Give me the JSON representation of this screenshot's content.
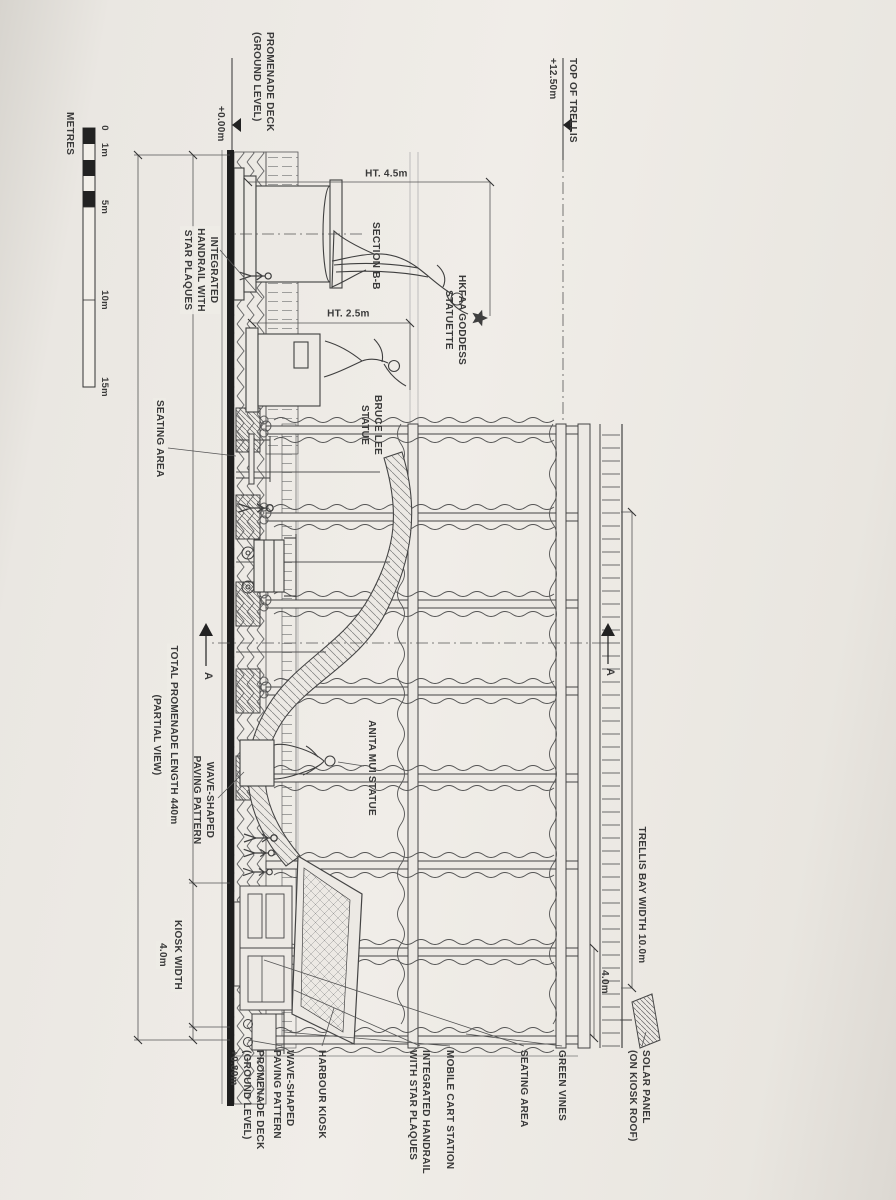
{
  "colors": {
    "paper": "#ECE9E4",
    "ink": "#3A3A3A",
    "line": "#444444"
  },
  "scale_bar": {
    "title": "METRES",
    "ticks": [
      "0",
      "1m",
      "5m",
      "10m",
      "15m"
    ]
  },
  "levels": {
    "promenade_deck": {
      "name": "PROMENADE DECK\n(GROUND LEVEL)",
      "value": "+0.00m"
    },
    "top_of_trellis": {
      "name": "TOP OF TRELLIS",
      "value": "+12.50m"
    }
  },
  "dimensions": {
    "goddess_height": "HT. 4.5m",
    "bruce_lee_height": "HT. 2.5m",
    "total_length": "TOTAL PROMENADE LENGTH 440m",
    "total_length_note": "(PARTIAL VIEW)",
    "kiosk_width_label": "KIOSK WIDTH",
    "kiosk_width_value": "4.0m",
    "trellis_bay_width": "TRELLIS BAY WIDTH 10.0m",
    "end_bay_width": "4.0m"
  },
  "section_markers": {
    "a": "A",
    "b": "SECTION B-B"
  },
  "labels": {
    "handrail_left": "INTEGRATED\nHANDRAIL WITH\nSTAR PLAQUES",
    "seating_left": "SEATING AREA",
    "goddess": "HKFAA GODDESS\nSTATUETTE",
    "bruce_lee": "BRUCE LEE\nSTATUE",
    "anita_mui": "ANITA MUI STATUE",
    "wave_paving_left": "WAVE-SHAPED\nPAVING PATTERN",
    "harbour_kiosk": "HARBOUR KIOSK",
    "wave_paving_right": "WAVE-SHAPED\nPAVING PATTERN",
    "deck_right": "PROMENADE DECK\n(GROUND LEVEL)\n+0.80m",
    "handrail_right": "INTEGRATED HANDRAIL\nWITH STAR PLAQUES",
    "mobile_cart": "MOBILE CART STATION",
    "seating_right": "SEATING AREA",
    "greenery": "GREEN VINES",
    "solar": "SOLAR PANEL\n(ON KIOSK ROOF)"
  }
}
